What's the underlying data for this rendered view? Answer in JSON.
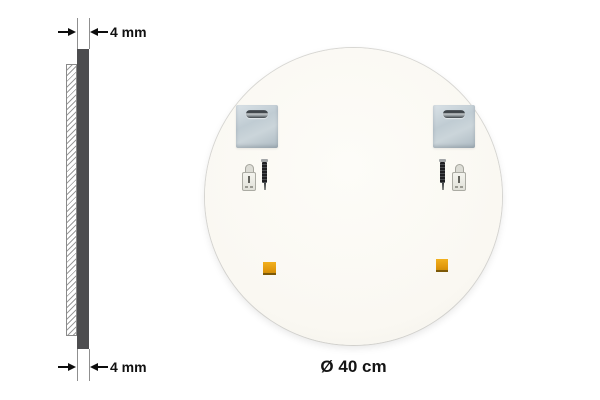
{
  "side_view": {
    "thickness_top_label": "4 mm",
    "thickness_bottom_label": "4 mm"
  },
  "back_view": {
    "diameter_label": "Ø 40 cm",
    "hardware_icons": [
      "keyhole-mounting-plate-icon",
      "screw-icon",
      "wall-anchor-icon",
      "adhesive-pad-icon"
    ]
  },
  "colors": {
    "background": "#ffffff",
    "mirror_back_fill": "#fbf9f3",
    "edge_profile": "#4d4d4f",
    "mounting_plate": "#c3ced5",
    "adhesive_pad": "#e59a0c",
    "dimension_text": "#111111"
  }
}
